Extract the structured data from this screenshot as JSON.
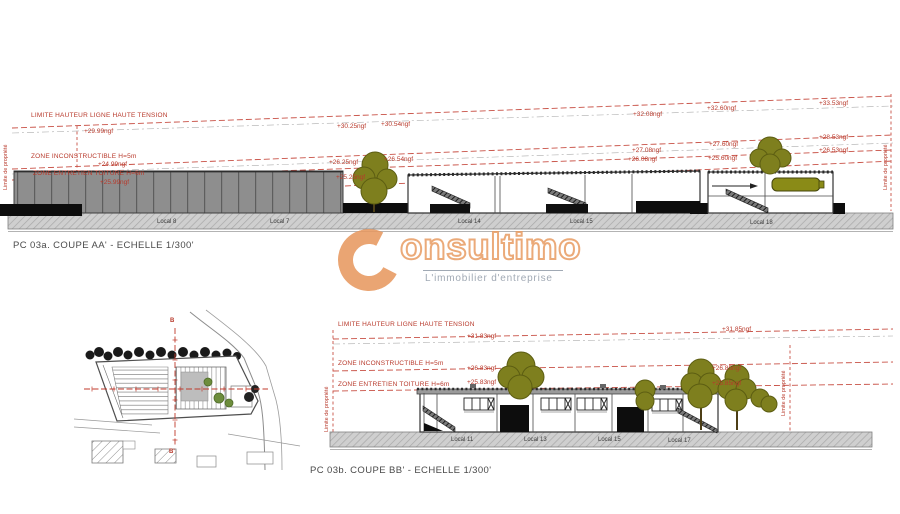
{
  "watermark": {
    "initial": "C",
    "rest": "onsultimo",
    "tagline": "L'immobilier d'entreprise",
    "color": "#e8995f"
  },
  "coupe_aa": {
    "caption": "PC 03a. COUPE AA' - ECHELLE 1/300'",
    "labels": {
      "tension": "LIMITE HAUTEUR LIGNE HAUTE TENSION",
      "inconstructible": "ZONE INCONSTRUCTIBLE H=5m",
      "entretien": "ZONE ENTRETIEN TOITURE H=6m"
    },
    "limite": "Limite de propriété",
    "row1": [
      "+29.99ngf",
      "+30.25ngf",
      "+30.54ngf",
      "+32.08ngf",
      "+32.60ngf",
      "+33.53ngf"
    ],
    "row2": [
      "+24.99ngf",
      "+26.25ngf",
      "+26.54ngf",
      "+27.08ngf",
      "+27.60ngf",
      "+28.53ngf"
    ],
    "row3": [
      "+25.99ngf",
      "+25.25ngf",
      "+26.08ngf",
      "+25.60ngf",
      "+26.53ngf"
    ],
    "locals": [
      "Local 8",
      "Local 7",
      "Local 14",
      "Local 15",
      "Local 18"
    ]
  },
  "coupe_bb": {
    "caption": "PC 03b. COUPE BB' - ECHELLE 1/300'",
    "labels": {
      "tension": "LIMITE HAUTEUR LIGNE HAUTE TENSION",
      "inconstructible": "ZONE INCONSTRUCTIBLE H=5m",
      "entretien": "ZONE ENTRETIEN TOITURE H=6m"
    },
    "limite": "Limite de propriété",
    "vals": [
      "+31.83ngf",
      "+31.85ngf",
      "+26.83ngf",
      "+25.83ngf",
      "+26.85ngf",
      "+25.85ngf"
    ],
    "locals": [
      "Local 11",
      "Local 13",
      "Local 15",
      "Local 17"
    ]
  },
  "site_plan": {
    "marker_top": "B",
    "marker_bottom": "B'"
  }
}
